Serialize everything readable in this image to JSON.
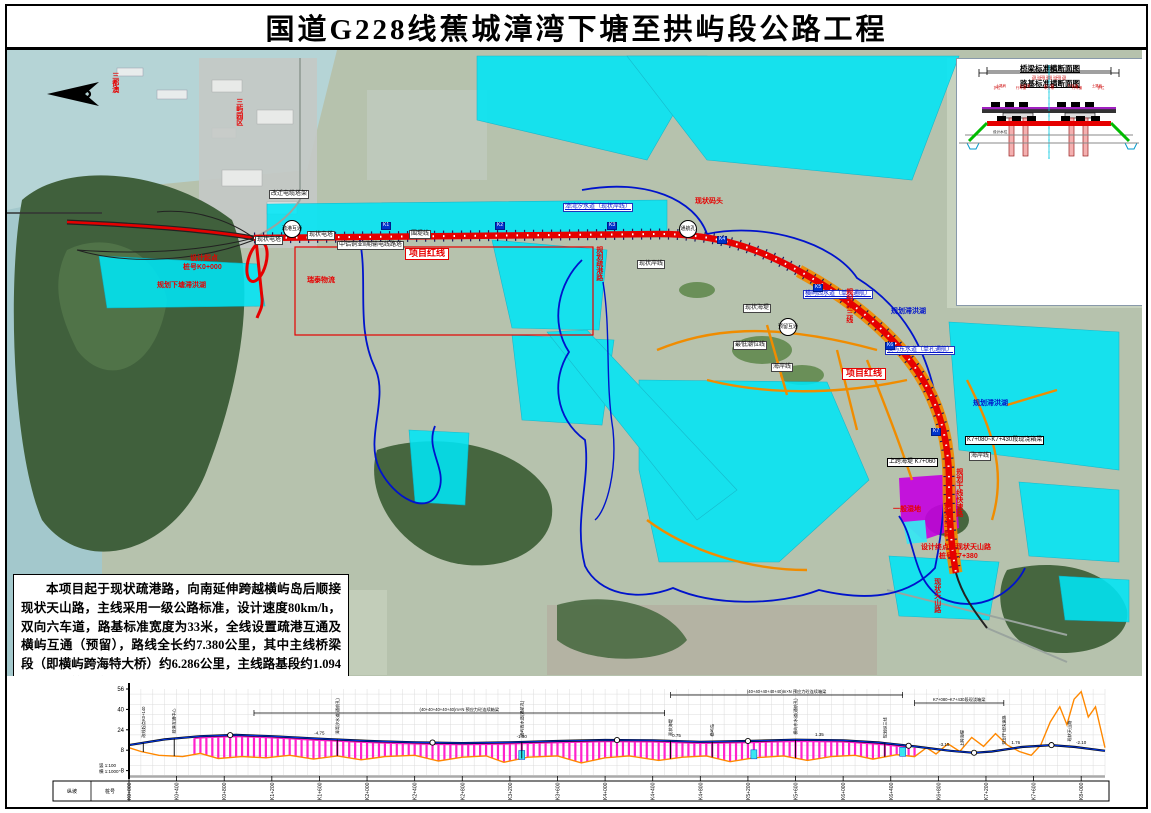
{
  "title": "国道G228线蕉城漳湾下塘至拱屿段公路工程",
  "description": "本项目起于现状疏港路，向南延伸跨越横屿岛后顺接现状天山路，主线采用一级公路标准，设计速度80km/h，双向六车道，路基标准宽度为33米，全线设置疏港互通及横屿互通（预留），路线全长约7.380公里，其中主线桥梁段（即横屿跨海特大桥）约6.286公里，主线路基段约1.094公里。估算建安费用约16.984亿元，总投资约20.931亿元。",
  "inset": {
    "bridge_title": "桥梁标准横断面图",
    "roadbed_title": "路基标准横断面图",
    "bridge_dim_total": "3350",
    "bridge_dims": "50  1475  300  1475  50",
    "roadbed_dim_total": "3300",
    "roadbed_dims": "75  1425  300  1425  75",
    "water_label": "设计水位"
  },
  "colors": {
    "route_red": "#e60000",
    "planning_water_cyan": "#00e6f6",
    "planning_road_orange": "#f08c00",
    "boundary_blue": "#0013cc",
    "wetland_purple": "#c400e0",
    "profile_design_blue": "#0033dd",
    "profile_ground_orange": "#ff8800",
    "profile_bridge_magenta": "#ff22cc"
  },
  "map": {
    "labels": [
      {
        "t": "三都澳",
        "x": 104,
        "y": 22,
        "c": "redv"
      },
      {
        "t": "三屿园区",
        "x": 228,
        "y": 48,
        "c": "redv"
      },
      {
        "t": "改迁电缆塔架",
        "x": 262,
        "y": 140,
        "c": "box"
      },
      {
        "t": "现状电塔",
        "x": 248,
        "y": 186,
        "c": "box"
      },
      {
        "t": "现状电塔",
        "x": 300,
        "y": 181,
        "c": "box"
      },
      {
        "t": "中铝铜业Ⅱ期输电线路塔",
        "x": 330,
        "y": 191,
        "c": "box"
      },
      {
        "t": "围堤线",
        "x": 402,
        "y": 180,
        "c": "box"
      },
      {
        "t": "项目红线",
        "x": 398,
        "y": 198,
        "c": "redframe"
      },
      {
        "t": "项目红线",
        "x": 835,
        "y": 318,
        "c": "redframe"
      },
      {
        "t": "设计起点",
        "x": 183,
        "y": 205,
        "c": "red"
      },
      {
        "t": "桩号K0+000",
        "x": 176,
        "y": 214,
        "c": "red"
      },
      {
        "t": "规划下塘滞洪湖",
        "x": 150,
        "y": 232,
        "c": "red"
      },
      {
        "t": "瑞泰物流",
        "x": 300,
        "y": 227,
        "c": "red"
      },
      {
        "t": "疏港互通",
        "x": 276,
        "y": 170,
        "c": "circle"
      },
      {
        "t": "漳湾汐水道（现状岸线）",
        "x": 556,
        "y": 153,
        "c": "bluebox"
      },
      {
        "t": "现状岸线",
        "x": 630,
        "y": 210,
        "c": "box"
      },
      {
        "t": "规划疏港路",
        "x": 588,
        "y": 196,
        "c": "redv"
      },
      {
        "t": "通航孔",
        "x": 672,
        "y": 170,
        "c": "circle"
      },
      {
        "t": "现状码头",
        "x": 688,
        "y": 148,
        "c": "red"
      },
      {
        "t": "预留互通",
        "x": 772,
        "y": 268,
        "c": "circle"
      },
      {
        "t": "现状海堤",
        "x": 736,
        "y": 254,
        "c": "box"
      },
      {
        "t": "最低潮位线",
        "x": 726,
        "y": 291,
        "c": "box"
      },
      {
        "t": "海岸线",
        "x": 764,
        "y": 313,
        "c": "box"
      },
      {
        "t": "横屿西水道（单孔通航）",
        "x": 796,
        "y": 240,
        "c": "bluebox"
      },
      {
        "t": "规划滞洪湖",
        "x": 884,
        "y": 258,
        "c": "blue"
      },
      {
        "t": "横屿东水道（单孔通航）",
        "x": 878,
        "y": 296,
        "c": "bluebox"
      },
      {
        "t": "规划纵三线",
        "x": 838,
        "y": 238,
        "c": "redv"
      },
      {
        "t": "规划滞洪湖",
        "x": 966,
        "y": 350,
        "c": "blue"
      },
      {
        "t": "K7+080~K7+430段现浇箱梁",
        "x": 958,
        "y": 386,
        "c": "blackbox"
      },
      {
        "t": "上跨海堤 K7+060",
        "x": 880,
        "y": 408,
        "c": "blackbox"
      },
      {
        "t": "海岸线",
        "x": 962,
        "y": 402,
        "c": "box"
      },
      {
        "t": "一般湿地",
        "x": 886,
        "y": 456,
        "c": "red"
      },
      {
        "t": "规划干线快速路",
        "x": 948,
        "y": 418,
        "c": "redv"
      },
      {
        "t": "规划次干路",
        "x": 936,
        "y": 452,
        "c": "redv"
      },
      {
        "t": "设计终点接现状天山路",
        "x": 914,
        "y": 494,
        "c": "red"
      },
      {
        "t": "桩号K7+380",
        "x": 932,
        "y": 503,
        "c": "red"
      },
      {
        "t": "现状天山路",
        "x": 926,
        "y": 528,
        "c": "redv"
      }
    ],
    "km_markers": [
      {
        "t": "K1",
        "x": 374,
        "y": 172
      },
      {
        "t": "K2",
        "x": 488,
        "y": 172
      },
      {
        "t": "K3",
        "x": 600,
        "y": 172
      },
      {
        "t": "K4",
        "x": 710,
        "y": 186
      },
      {
        "t": "K5",
        "x": 806,
        "y": 234
      },
      {
        "t": "K6",
        "x": 878,
        "y": 292
      },
      {
        "t": "K7",
        "x": 924,
        "y": 378
      }
    ]
  },
  "chart_data": {
    "type": "line",
    "title": "路线纵断面示意",
    "xlabel": "桩号",
    "ylabel": "高程(m)",
    "ylim": [
      -8,
      56
    ],
    "yticks": [
      56,
      40,
      24,
      8,
      -8
    ],
    "x_km_max": 8.2,
    "scale_vertical": "竖 1:100",
    "scale_horizontal": "横 1:1000",
    "row_headers": [
      "纵坡",
      "桩号"
    ],
    "chainage_labels": [
      "K0+000",
      "K0+400",
      "K0+800",
      "K1+200",
      "K1+600",
      "K2+000",
      "K2+400",
      "K2+800",
      "K3+200",
      "K3+600",
      "K4+000",
      "K4+400",
      "K4+800",
      "K5+200",
      "K5+600",
      "K6+000",
      "K6+400",
      "K6+800",
      "K7+200",
      "K7+600",
      "K8+000"
    ],
    "series": [
      {
        "name": "设计线",
        "color": "#0033dd",
        "points": [
          [
            0,
            12
          ],
          [
            0.3,
            16.5
          ],
          [
            0.6,
            19
          ],
          [
            0.9,
            20
          ],
          [
            1.2,
            19
          ],
          [
            1.6,
            17
          ],
          [
            2.0,
            15.3
          ],
          [
            2.4,
            14.2
          ],
          [
            2.8,
            13.6
          ],
          [
            3.2,
            14.2
          ],
          [
            3.6,
            15.2
          ],
          [
            4.0,
            16
          ],
          [
            4.4,
            15.8
          ],
          [
            4.8,
            14.6
          ],
          [
            5.2,
            15.2
          ],
          [
            5.6,
            16.2
          ],
          [
            6.0,
            15.8
          ],
          [
            6.3,
            14
          ],
          [
            6.6,
            11
          ],
          [
            6.9,
            7.5
          ],
          [
            7.1,
            6
          ],
          [
            7.25,
            7
          ],
          [
            7.5,
            10.5
          ],
          [
            7.75,
            12
          ],
          [
            7.95,
            10.5
          ],
          [
            8.2,
            7.5
          ]
        ]
      },
      {
        "name": "地面线",
        "color": "#ff8800",
        "points": [
          [
            0,
            10
          ],
          [
            0.1,
            7
          ],
          [
            0.25,
            4
          ],
          [
            0.45,
            3
          ],
          [
            0.6,
            5.5
          ],
          [
            0.75,
            1.5
          ],
          [
            0.95,
            3
          ],
          [
            1.15,
            2
          ],
          [
            1.35,
            4
          ],
          [
            1.55,
            1
          ],
          [
            1.75,
            3.5
          ],
          [
            1.95,
            0.5
          ],
          [
            2.15,
            3
          ],
          [
            2.4,
            4
          ],
          [
            2.6,
            -0.5
          ],
          [
            2.8,
            2.5
          ],
          [
            3.0,
            3.5
          ],
          [
            3.15,
            -1.5
          ],
          [
            3.35,
            2.5
          ],
          [
            3.6,
            3.5
          ],
          [
            3.8,
            -2
          ],
          [
            4.0,
            2
          ],
          [
            4.2,
            3.5
          ],
          [
            4.45,
            0
          ],
          [
            4.65,
            2.5
          ],
          [
            4.85,
            3.5
          ],
          [
            5.05,
            -1
          ],
          [
            5.25,
            2
          ],
          [
            5.5,
            3.5
          ],
          [
            5.7,
            0
          ],
          [
            5.9,
            3
          ],
          [
            6.1,
            4
          ],
          [
            6.25,
            1
          ],
          [
            6.45,
            4.5
          ],
          [
            6.6,
            3
          ],
          [
            6.7,
            10
          ],
          [
            6.78,
            5
          ],
          [
            6.88,
            13
          ],
          [
            6.98,
            7
          ],
          [
            7.08,
            18
          ],
          [
            7.18,
            11
          ],
          [
            7.28,
            21
          ],
          [
            7.38,
            12
          ],
          [
            7.48,
            7
          ],
          [
            7.58,
            4
          ],
          [
            7.66,
            12
          ],
          [
            7.74,
            30
          ],
          [
            7.82,
            42
          ],
          [
            7.88,
            28
          ],
          [
            7.94,
            48
          ],
          [
            8.0,
            54
          ],
          [
            8.06,
            34
          ],
          [
            8.12,
            42
          ],
          [
            8.18,
            18
          ],
          [
            8.2,
            10
          ]
        ]
      }
    ],
    "bridge_range_km": [
      0.55,
      6.6
    ],
    "nav_channel_km": [
      3.3,
      5.25,
      6.5
    ],
    "curve_points_km": [
      0.85,
      2.55,
      4.1,
      5.2,
      6.55,
      7.1,
      7.75
    ],
    "grade_labels": [
      {
        "km": 1.6,
        "t": "-4.75"
      },
      {
        "km": 3.3,
        "t": "-1.30"
      },
      {
        "km": 4.6,
        "t": "0.75"
      },
      {
        "km": 5.8,
        "t": "1.35"
      },
      {
        "km": 6.85,
        "t": "-3.15"
      },
      {
        "km": 7.45,
        "t": "1.76"
      },
      {
        "km": 8.0,
        "t": "-2.10"
      }
    ],
    "span_annotations": [
      {
        "k0": 1.05,
        "k1": 4.5,
        "y": 34,
        "t": "(40+40+40+40+40)m×N 预应力砼连续箱梁"
      },
      {
        "k0": 4.55,
        "k1": 6.5,
        "y": 16,
        "t": "(40+40+40+40+40)m×N 预应力砼连续箱梁"
      },
      {
        "k0": 6.6,
        "k1": 7.35,
        "y": 24,
        "t": "K7+080~K7+430段现浇箱梁"
      }
    ],
    "structure_annotations": [
      {
        "km": 0.12,
        "t": "改线起点K0+140"
      },
      {
        "km": 0.38,
        "t": "疏港互通中心"
      },
      {
        "km": 1.75,
        "t": "漳湾汐水道(通航孔)"
      },
      {
        "km": 3.3,
        "t": "横屿西水道(通航孔)"
      },
      {
        "km": 4.55,
        "t": "现状海堤"
      },
      {
        "km": 4.9,
        "t": "横屿岛"
      },
      {
        "km": 5.6,
        "t": "横屿东水道(通航孔)"
      },
      {
        "km": 6.35,
        "t": "规划纵三线"
      },
      {
        "km": 7.0,
        "t": "上跨海堤"
      },
      {
        "km": 7.35,
        "t": "规划干线快速路"
      },
      {
        "km": 7.9,
        "t": "现状天山路"
      }
    ]
  }
}
